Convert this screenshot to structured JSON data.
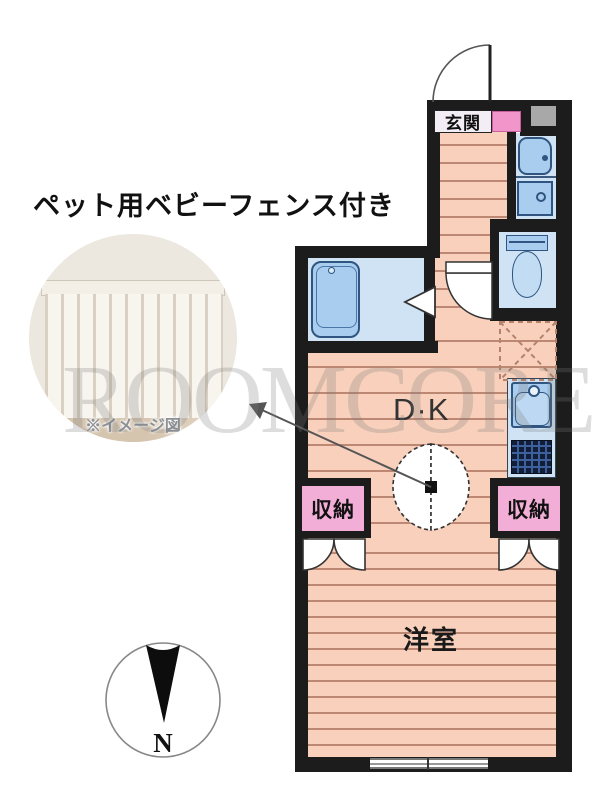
{
  "header": {
    "title": "ペット用ベビーフェンス付き"
  },
  "photo": {
    "caption": "※イメージ図"
  },
  "watermark": {
    "text": "ROOMCORE"
  },
  "floorplan": {
    "rooms": {
      "entrance": "玄関",
      "dining_kitchen": "D·K",
      "western_room": "洋室",
      "storage_left": "収納",
      "storage_right": "収納"
    },
    "compass": {
      "label": "N"
    },
    "colors": {
      "wall": "#1c1c1c",
      "floor": "#f8d0bb",
      "plank": "#bd8873",
      "room_blue": "#cfe3f5",
      "fixture_blue": "#a9cdee",
      "fixture_border": "#2f5580",
      "closet_pink": "#f2aed6",
      "shoe_pink": "#f295ca",
      "gray_box": "#a8a8a8",
      "label_bg": "#f3edf6"
    }
  }
}
